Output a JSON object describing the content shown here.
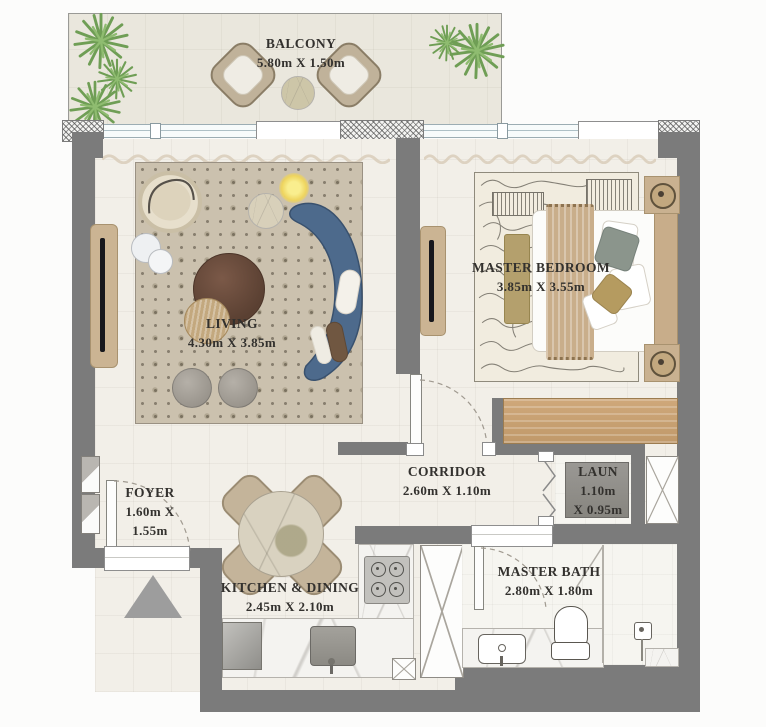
{
  "colors": {
    "wall": "#7b7b7b",
    "floor": "#f2efe8",
    "balcony_floor": "#eae7dd",
    "living_rug": "#cbc1ae",
    "bedroom_rug": "#f1ecdf",
    "sofa_blue": "#4d6a8c",
    "wood": "#c8a878",
    "plant_green": "#7da861",
    "appliance_gray": "#928f8a",
    "marble": "#f4f3f0",
    "label_text": "#33312e"
  },
  "rooms": {
    "balcony": {
      "name": "BALCONY",
      "dims": "5.80m X 1.50m"
    },
    "living": {
      "name": "LIVING",
      "dims": "4.30m X 3.85m"
    },
    "master_bedroom": {
      "name": "MASTER BEDROOM",
      "dims": "3.85m X 3.55m"
    },
    "corridor": {
      "name": "CORRIDOR",
      "dims": "2.60m X 1.10m"
    },
    "foyer": {
      "name": "FOYER",
      "dims_line1": "1.60m X",
      "dims_line2": "1.55m"
    },
    "laundry": {
      "name": "LAUN",
      "dims_line1": "1.10m",
      "dims_line2": "X 0.95m"
    },
    "kitchen_dining": {
      "name": "KITCHEN & DINING",
      "dims": "2.45m X 2.10m"
    },
    "master_bath": {
      "name": "MASTER BATH",
      "dims": "2.80m X 1.80m"
    }
  }
}
